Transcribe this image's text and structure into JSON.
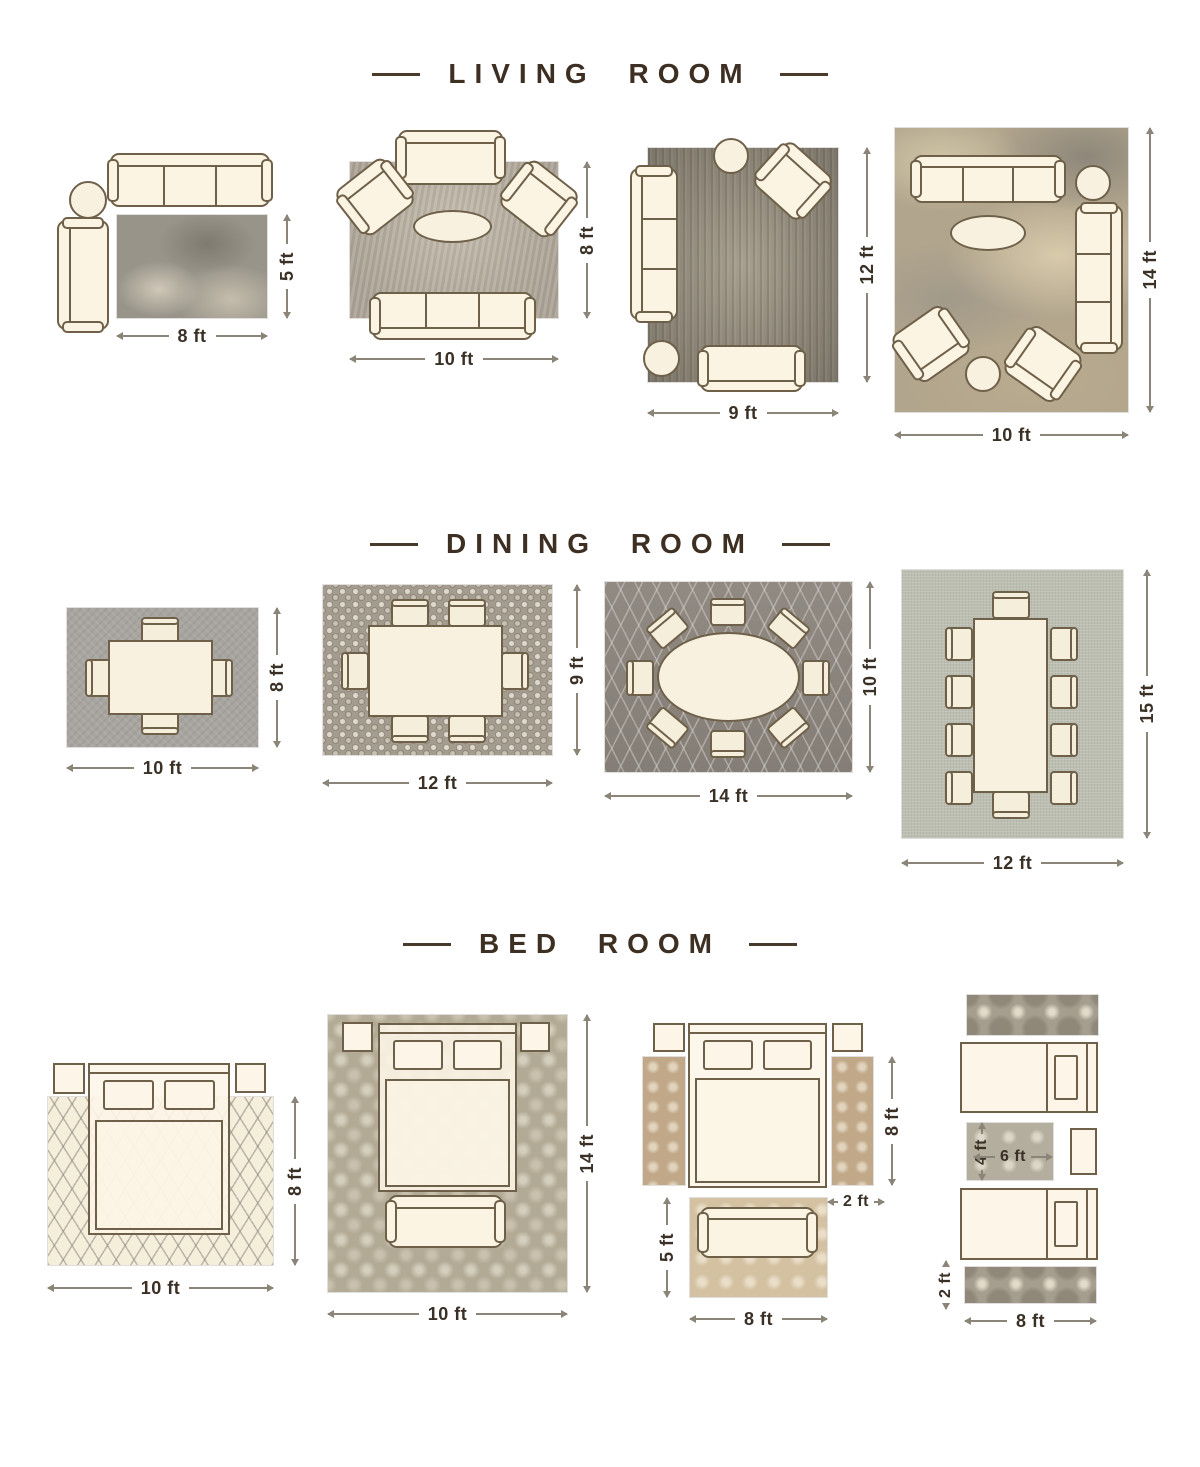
{
  "titles": {
    "living": "LIVING ROOM",
    "dining": "DINING ROOM",
    "bedroom": "BED ROOM"
  },
  "living": {
    "l1": {
      "w": "8 ft",
      "h": "5 ft"
    },
    "l2": {
      "w": "10 ft",
      "h": "8 ft"
    },
    "l3": {
      "w": "9 ft",
      "h": "12 ft"
    },
    "l4": {
      "w": "10 ft",
      "h": "14 ft"
    }
  },
  "dining": {
    "d1": {
      "w": "10 ft",
      "h": "8 ft"
    },
    "d2": {
      "w": "12 ft",
      "h": "9 ft"
    },
    "d3": {
      "w": "14 ft",
      "h": "10 ft"
    },
    "d4": {
      "w": "12 ft",
      "h": "15 ft"
    }
  },
  "bedroom": {
    "b1": {
      "w": "10 ft",
      "h": "8 ft"
    },
    "b2": {
      "w": "10 ft",
      "h": "14 ft"
    },
    "b3": {
      "runner_h": "8 ft",
      "runner_w": "2 ft",
      "rug_h": "5 ft",
      "rug_w": "8 ft"
    },
    "b4": {
      "rug_h": "4 ft",
      "rug_w": "6 ft",
      "runner_w": "2 ft",
      "runner_l": "8 ft"
    }
  },
  "colors": {
    "title_text": "#3e2f23",
    "dimension_text": "#3a3026",
    "furniture_outline": "#6f6049",
    "furniture_fill": "#fbf4e3"
  }
}
